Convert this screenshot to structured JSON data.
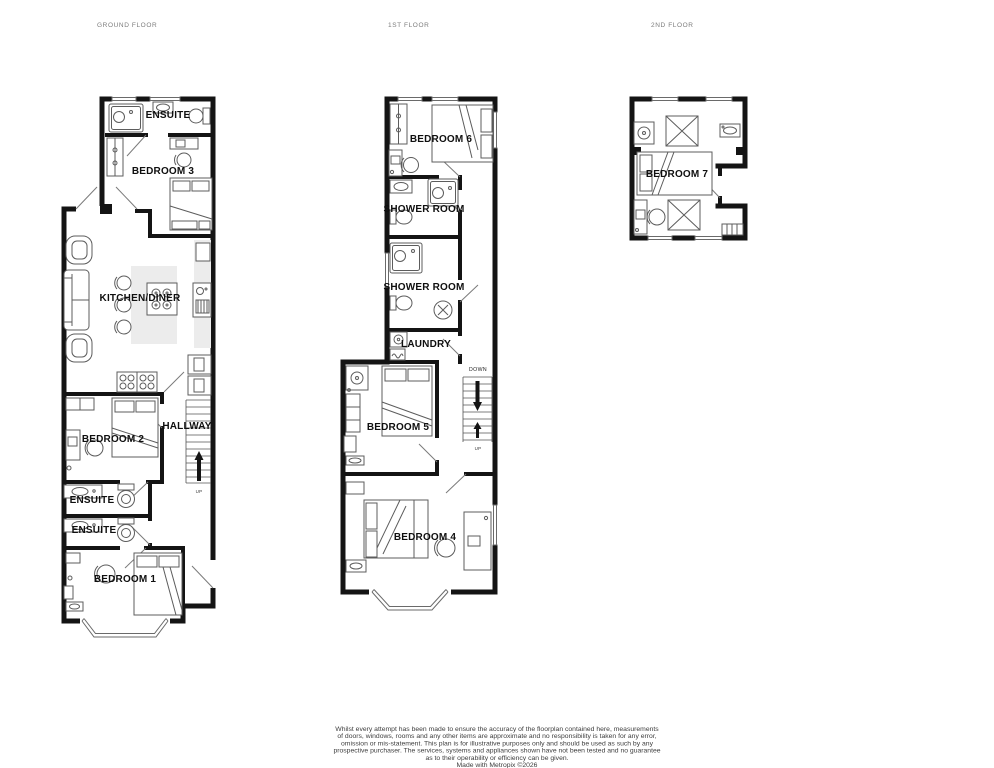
{
  "floors": {
    "ground": {
      "title": "GROUND FLOOR"
    },
    "first": {
      "title": "1ST FLOOR"
    },
    "second": {
      "title": "2ND FLOOR"
    }
  },
  "rooms": {
    "ground": {
      "ensuite_top": "ENSUITE",
      "bedroom3": "BEDROOM 3",
      "kitchen_diner": "KITCHEN/DINER",
      "bedroom2": "BEDROOM 2",
      "hallway": "HALLWAY",
      "ensuite_mid": "ENSUITE",
      "ensuite_lower": "ENSUITE",
      "bedroom1": "BEDROOM 1"
    },
    "first": {
      "bedroom6": "BEDROOM 6",
      "shower_room_upper": "SHOWER ROOM",
      "shower_room_lower": "SHOWER ROOM",
      "laundry": "LAUNDRY",
      "bedroom5": "BEDROOM 5",
      "bedroom4": "BEDROOM 4"
    },
    "second": {
      "bedroom7": "BEDROOM 7"
    }
  },
  "stairs": {
    "ground_up": "UP",
    "first_down": "DOWN",
    "first_up": "UP"
  },
  "disclaimer": {
    "line1": "Whilst every attempt has been made to ensure the accuracy of the floorplan contained here, measurements",
    "line2": "of doors, windows, rooms and any other items are approximate and no responsibility is taken for any error,",
    "line3": "omission or mis-statement. This plan is for illustrative purposes only and should be used as such by any",
    "line4": "prospective purchaser. The services, systems and appliances shown have not been tested and no guarantee",
    "line5": "as to their operability or efficiency can be given.",
    "credit": "Made with Metropix ©2026"
  },
  "colors": {
    "background": "#ffffff",
    "wall": "#141414",
    "furniture_line": "#5c5c5c",
    "room_fill": "#ffffff",
    "counter_shading": "#ececec",
    "room_label_text": "#0f0f0f",
    "floor_title_text": "#7c7c7c",
    "disclaimer_text": "#3d3d3d"
  }
}
